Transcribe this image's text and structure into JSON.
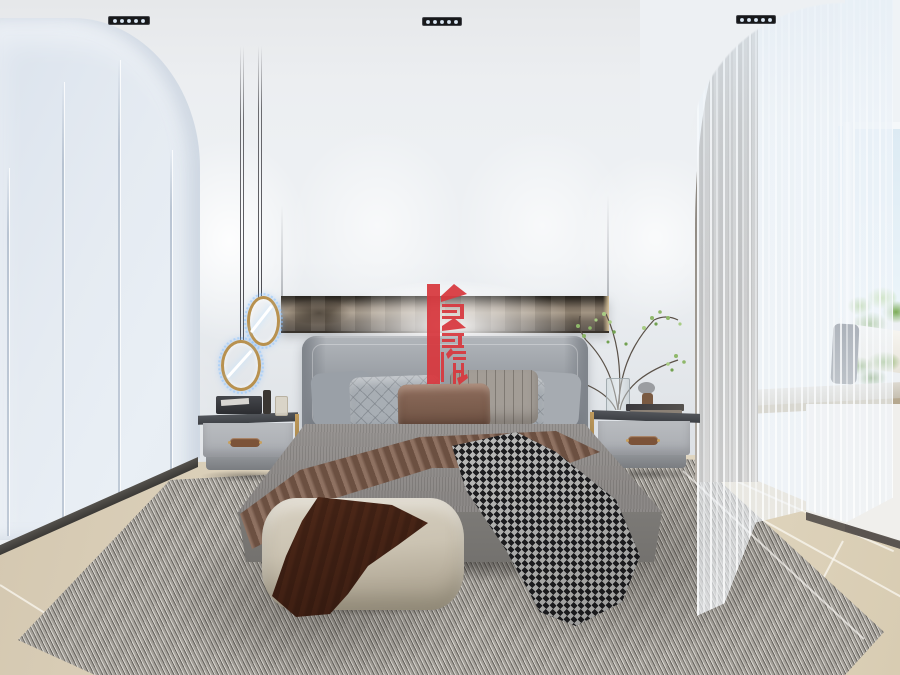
{
  "scene": {
    "description": "Modern minimalist bedroom interior render with bed, wardrobe, pendant ring lights, sheer curtains and bay window",
    "watermark": {
      "text": "鑫耀",
      "color": "#d8383e"
    },
    "lighting": {
      "ceiling_spotlights": 3,
      "pendant_rings": 2
    }
  },
  "palette": {
    "wall": "#edf0f3",
    "wardrobe_light": "#e9eff5",
    "wardrobe_shade": "#dbe3ed",
    "bronze_panel": "#87796a",
    "headboard": "#999ea4",
    "bedding": "#979390",
    "blanket_brown": "#7b5d4d",
    "throw_dark": "#232326",
    "throw_light": "#d8d8d6",
    "pouf": "#cbc3b2",
    "rug": "#b5b1aa",
    "floor": "#ddd2bc",
    "curtain_gray": "#837c73",
    "sky": "#dceaf3",
    "greenery": "#84ad5f",
    "nightstand_body": "#b9bcc0",
    "nightstand_top": "#3d4045",
    "brass": "#c7a05e",
    "leather_handle": "#7c5338",
    "pendant_gold": "#b8914f",
    "accent_red": "#d8383e"
  }
}
